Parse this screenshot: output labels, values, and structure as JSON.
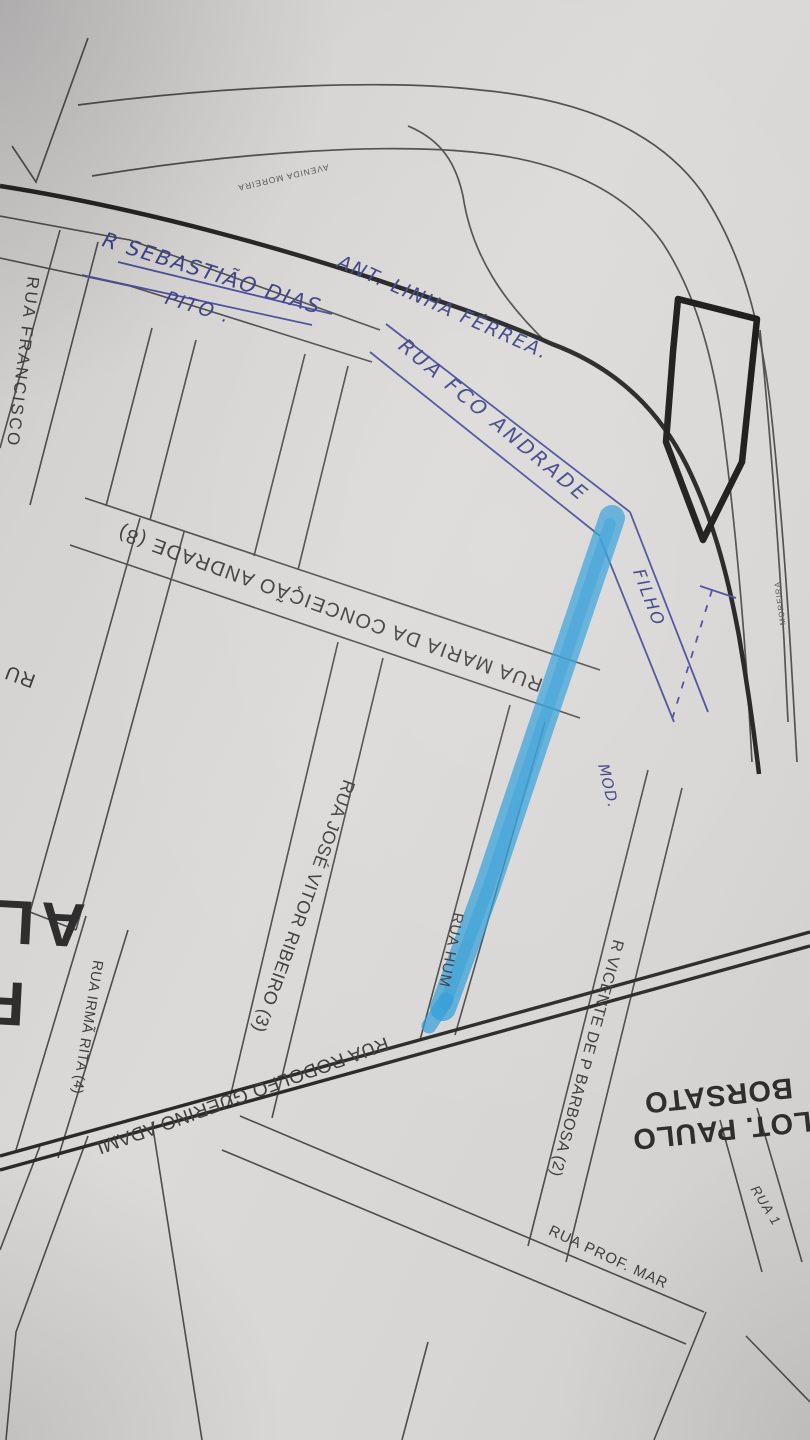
{
  "meta": {
    "description": "Photograph of a hand-annotated printed street map (loteamento plan), with one street highlighted in blue marker"
  },
  "colors": {
    "paper": "#d7d5d3",
    "printed_ink": "#4d4d4d",
    "heavy_ink": "#212121",
    "pen_ink": "#3e4186",
    "marker_blue": "#2d9cd8"
  },
  "labels": {
    "avenida_moreira": "AVENIDA MOREIRA",
    "moreira_edge": "MOREIRA",
    "sebastiao_dias": "R SEBASTIÃO DIAS",
    "pito": "PITO .",
    "linha_ferrea": "ANT. LINHA FÉRREA.",
    "fco_andrade": "RUA FCO ANDRADE",
    "filho": "FILHO",
    "maria_conceicao": "RUA MARIA DA CONCEIÇÃO ANDRADE (8)",
    "rua_francisco": "RUA FRANCISCO",
    "rua_fragment": "RU",
    "mod": "MOD.",
    "jose_vitor": "RUA JOSÉ VITOR RIBEIRO (3)",
    "rua_hum": "RUA HUM",
    "irma_rita": "RUA IRMÃ RITA (4)",
    "rodolfo": "RUA RODOLFO GUERINO ADAMI",
    "vicente": "R VICENTE DE P BARBOSA (2)",
    "lot_paulo_line1": "LOT. PAULO",
    "lot_paulo_line2": "BORSATO",
    "rua_prof": "RUA PROF. MAR",
    "rua_um": "RUA 1",
    "edge_letters_top": "AL",
    "edge_letter_bottom": "F"
  }
}
